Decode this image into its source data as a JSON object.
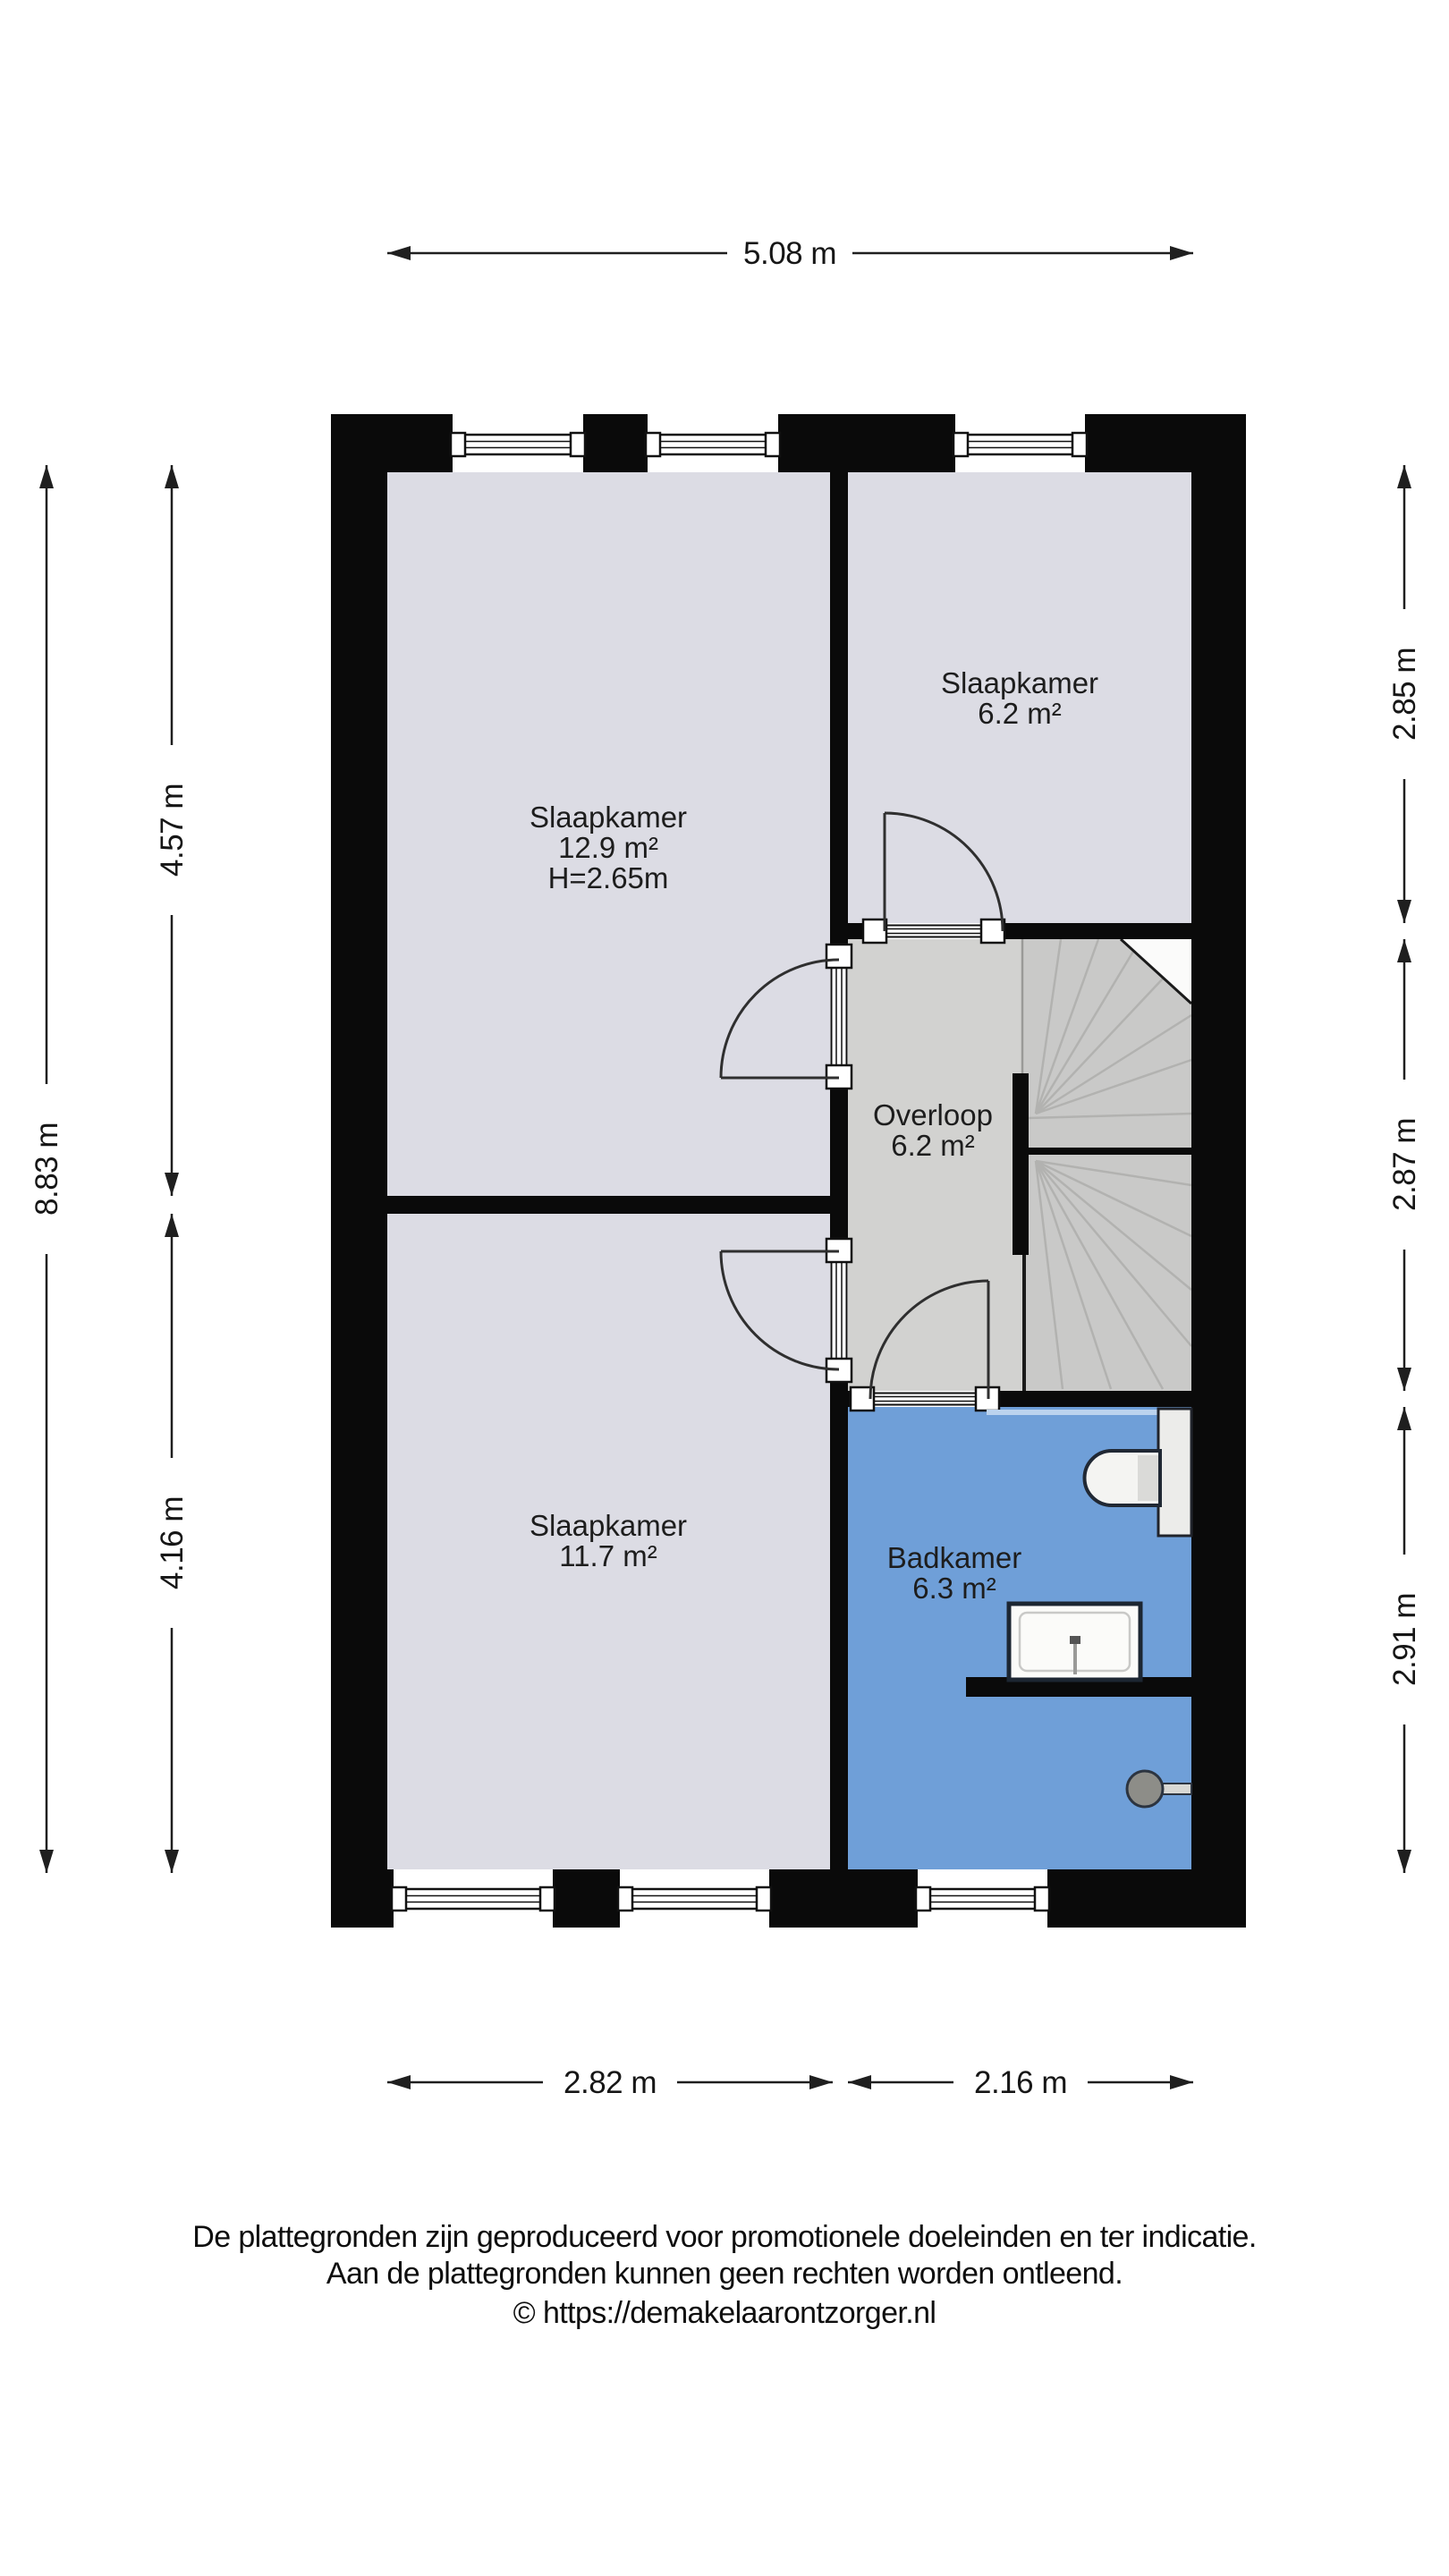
{
  "floorplan": {
    "rooms": [
      {
        "id": "slaapkamer-1",
        "name": "Slaapkamer",
        "area": "12.9 m²",
        "ceiling_height": "H=2.65m"
      },
      {
        "id": "slaapkamer-2",
        "name": "Slaapkamer",
        "area": "6.2 m²"
      },
      {
        "id": "overloop",
        "name": "Overloop",
        "area": "6.2 m²"
      },
      {
        "id": "slaapkamer-3",
        "name": "Slaapkamer",
        "area": "11.7 m²"
      },
      {
        "id": "badkamer",
        "name": "Badkamer",
        "area": "6.3 m²"
      }
    ],
    "dimensions": {
      "top_width": "5.08 m",
      "bottom_left_width": "2.82 m",
      "bottom_right_width": "2.16 m",
      "left_total": "8.83 m",
      "left_upper": "4.57 m",
      "left_lower": "4.16 m",
      "right_top": "2.85 m",
      "right_middle": "2.87 m",
      "right_bottom": "2.91 m"
    },
    "colors": {
      "wall": "#0a0a0a",
      "bedroom_floor": "#dcdce4",
      "landing_floor": "#d2d2d0",
      "stairs_floor": "#c9c9c8",
      "bathroom_floor": "#6f9fd8"
    }
  },
  "footer": {
    "line1": "De plattegronden zijn geproduceerd voor promotionele doeleinden en ter indicatie.",
    "line2": "Aan de plattegronden kunnen geen rechten worden ontleend.",
    "line3": "© https://demakelaarontzorger.nl"
  }
}
